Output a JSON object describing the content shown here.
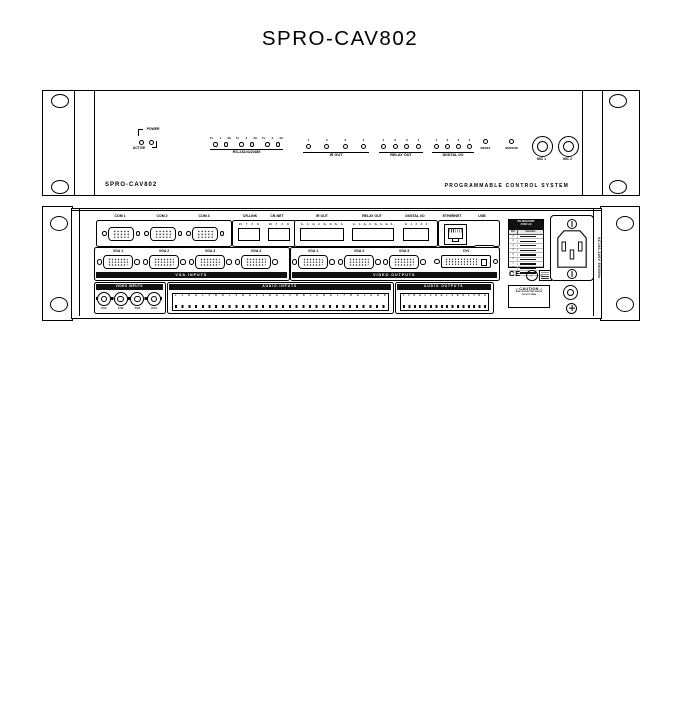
{
  "title": "SPRO-CAV802",
  "front": {
    "model": "SPRO-CAV802",
    "tagline": "PROGRAMMABLE CONTROL SYSTEM",
    "power_label": "POWER",
    "active_label": "ACTIVE",
    "serial": {
      "label": "RS-232/422/485",
      "pairs": [
        {
          "tx": "Tx",
          "num": "1",
          "rx": "Rx"
        },
        {
          "tx": "Tx",
          "num": "2",
          "rx": "Rx"
        },
        {
          "tx": "Tx",
          "num": "3",
          "rx": "Rx"
        }
      ]
    },
    "ir": {
      "label": "IR OUT",
      "leds": [
        "1",
        "2",
        "3",
        "4"
      ]
    },
    "relay": {
      "label": "RELAY OUT",
      "leds": [
        "1",
        "2",
        "3",
        "4"
      ]
    },
    "digital": {
      "label": "DIGITAL I/O",
      "leds": [
        "1",
        "2",
        "3",
        "4"
      ]
    },
    "reset_label": "RESET",
    "sensor_label": "SENSOR",
    "mic1_label": "MIC 1",
    "mic2_label": "MIC 2"
  },
  "rear": {
    "com": {
      "labels": [
        "COM 1",
        "COM 2",
        "COM 3"
      ]
    },
    "crlink": {
      "label": "CR-LINK",
      "pins": [
        "24",
        "Y",
        "Z",
        "G"
      ]
    },
    "crnet": {
      "label": "CR-NET",
      "pins": [
        "24",
        "Y",
        "Z",
        "G"
      ]
    },
    "irout": {
      "label": "IR OUT",
      "pins": [
        "1+",
        "1-",
        "2+",
        "2-",
        "3+",
        "3-",
        "4+",
        "4-"
      ]
    },
    "relayout": {
      "label": "RELAY OUT",
      "pins": [
        "1+",
        "1-",
        "2+",
        "2-",
        "3+",
        "3-",
        "4+",
        "4-"
      ]
    },
    "digitalio": {
      "label": "DIGITAL I/O",
      "pins": [
        "G",
        "1",
        "2",
        "3",
        "4"
      ]
    },
    "ethernet_label": "ETHERNET",
    "usb_label": "USB",
    "vga_inputs": {
      "strip": "VGA INPUTS",
      "labels": [
        "VGA 1",
        "VGA 2",
        "VGA 3",
        "VGA 4"
      ]
    },
    "video_outputs": {
      "strip": "VIDEO OUTPUTS",
      "labels": [
        "VGA 1",
        "VGA 2",
        "VGA 3"
      ],
      "dvi_label": "DVI"
    },
    "video_inputs": {
      "strip": "VIDEO INPUTS",
      "channels": [
        "CV1",
        "CV2",
        "CV3",
        "CV4"
      ]
    },
    "audio_inputs": {
      "strip": "AUDIO INPUTS",
      "pins": [
        "L",
        "1",
        "R",
        "G",
        "L",
        "2",
        "R",
        "G",
        "L",
        "3",
        "R",
        "G",
        "L",
        "4",
        "R",
        "G",
        "L",
        "5",
        "R",
        "G",
        "L",
        "6",
        "R",
        "G",
        "L",
        "7",
        "R",
        "G",
        "L",
        "8",
        "R",
        "G"
      ]
    },
    "audio_outputs": {
      "strip": "AUDIO OUTPUTS",
      "pins": [
        "L",
        "1",
        "R",
        "G",
        "L",
        "2",
        "R",
        "G",
        "L",
        "3",
        "R",
        "G",
        "L",
        "4",
        "R",
        "G"
      ]
    },
    "caution": {
      "title": "CAUTION",
      "line1": "RISK OF ELECTRIC SHOCK",
      "line2": "DO NOT OPEN"
    },
    "pin_table": {
      "title1": "RS-232/422/485",
      "title2": "(COM 1-3)",
      "col_pin": "Pin",
      "col_function": "Function",
      "rows": [
        "1",
        "2",
        "3",
        "4",
        "5",
        "6",
        "7",
        "8",
        "9"
      ]
    },
    "ce_label": "CE",
    "power_text": "AC100-240V 50/60Hz"
  }
}
